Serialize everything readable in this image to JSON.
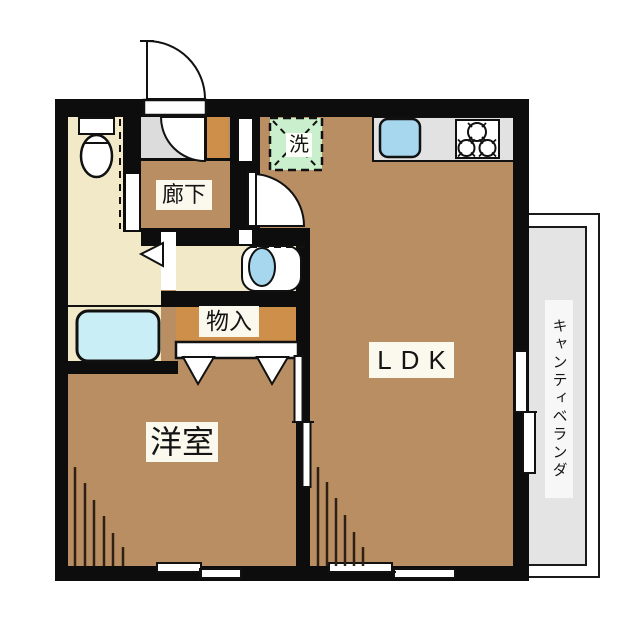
{
  "title": "1LDK floor plan",
  "labels": {
    "hallway": "廊下",
    "washing_machine": "洗",
    "ldk": "LDK",
    "storage": "物入",
    "western_room": "洋室",
    "veranda": "キャンティベランダ"
  },
  "rooms": [
    {
      "name": "hallway",
      "label": "廊下"
    },
    {
      "name": "ldk",
      "label": "LDK"
    },
    {
      "name": "western-room",
      "label": "洋室"
    },
    {
      "name": "storage",
      "label": "物入"
    },
    {
      "name": "veranda",
      "label": "キャンティベランダ"
    },
    {
      "name": "laundry-space",
      "label": "洗"
    }
  ],
  "fixtures": [
    "toilet",
    "bathtub",
    "washbasin",
    "kitchen-sink",
    "gas-stove-3-burner",
    "washing-machine-space",
    "entrance-door",
    "interior-doors",
    "sliding-windows",
    "closet-folding-doors"
  ],
  "colors": {
    "wall": "#0d0d0d",
    "room": "#b88e62",
    "storage": "#cd8f4a",
    "service": "#f1e9c8",
    "entry": "#dcdcdc",
    "counter": "#e2e2e2",
    "balcony": "#e4e4e4",
    "water": "#a6d7ee",
    "tub": "#c9eef6",
    "laundry": "#c9efcc",
    "label": "#fbf8ee",
    "line": "#2e2012"
  }
}
